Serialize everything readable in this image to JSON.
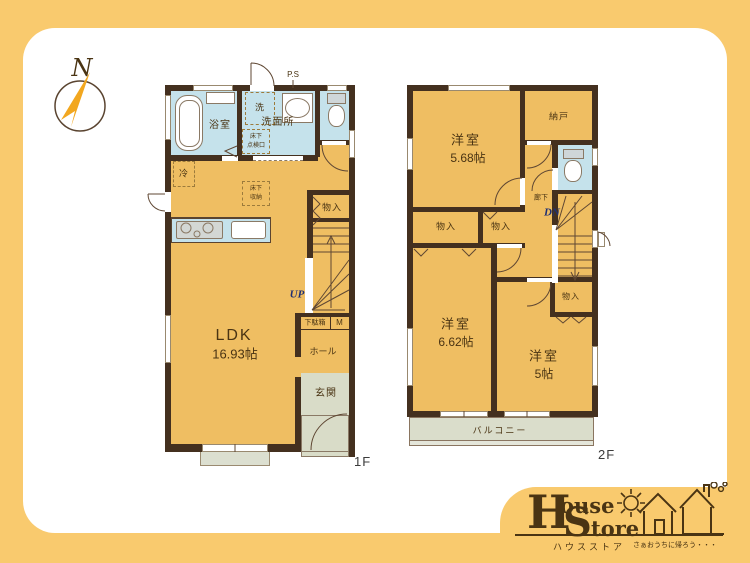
{
  "colors": {
    "background": "#F9CA6E",
    "card": "#FFFFFF",
    "floor": "#EFBE62",
    "wet_area": "#C5E2EB",
    "wall": "#44301F",
    "entry": "#D9DCC8",
    "balcony": "#DADDCB",
    "stair_text": "#1F2F73",
    "label_text": "#4A3413"
  },
  "compass": {
    "north": "N"
  },
  "floor1": {
    "label": "1F",
    "bath": "浴室",
    "washroom": "洗面所",
    "washer": "洗",
    "pipe_space": "P.S",
    "fridge": "冷",
    "hatch_line1": "床下",
    "hatch_line2": "点検口",
    "storage_line1": "床下",
    "storage_line2": "収納",
    "closet": "物入",
    "up": "UP",
    "shoebox": "下駄箱",
    "meter": "M",
    "hall": "ホール",
    "entrance": "玄関",
    "ldk": "LDK",
    "ldk_size": "16.93帖"
  },
  "floor2": {
    "label": "2F",
    "room_a": "洋室",
    "room_a_size": "5.68帖",
    "storeroom": "納戸",
    "corridor": "廊下",
    "dn": "DN",
    "closet": "物入",
    "room_b": "洋室",
    "room_b_size": "6.62帖",
    "room_c": "洋室",
    "room_c_size": "5帖",
    "balcony": "バルコニー"
  },
  "logo": {
    "h": "H",
    "ouse": "ouse",
    "s": "S",
    "tore": "tore",
    "katakana": "ハウスストア",
    "tagline": "さぁおうちに帰ろう・・・"
  }
}
